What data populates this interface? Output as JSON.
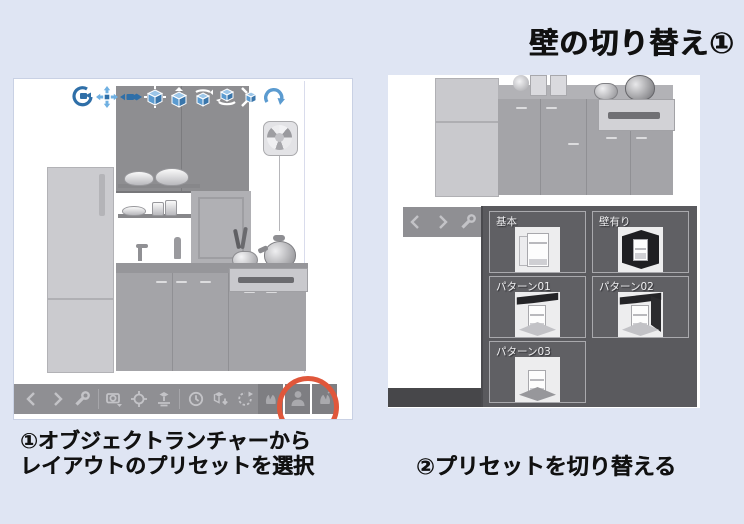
{
  "title": "壁の切り替え①",
  "colors": {
    "background": "#dfe5f3",
    "panel": "#ffffff",
    "toolbar_gray": "#8f8f93",
    "toolbar_icon": "#c3c3c7",
    "popup_gray": "#5a5a5e",
    "highlight_circle": "#e0573b",
    "tool_icon_blue": "#4e96cf"
  },
  "left_panel": {
    "top_toolbar": {
      "icons": [
        "camera-orbit",
        "camera-pan",
        "camera-zoom",
        "object-move",
        "object-lift",
        "object-rotate-y",
        "object-rotate-plane",
        "object-rotate-3d",
        "reset-view"
      ]
    },
    "bottom_toolbar": {
      "icons": [
        "prev",
        "next",
        "settings",
        "camera-angle",
        "focus-object",
        "object-ground",
        "pose-timer",
        "import-model",
        "rotate-reset",
        "hand-pose-left",
        "body-layout-preset",
        "hand-pose-right"
      ],
      "highlighted_icon": "body-layout-preset"
    },
    "caption": {
      "line1": "①オブジェクトランチャーから",
      "line2": "レイアウトのプリセットを選択"
    }
  },
  "right_panel": {
    "toolbar": {
      "icons": [
        "prev",
        "next",
        "settings"
      ]
    },
    "preset_panel": {
      "items": [
        {
          "label": "基本"
        },
        {
          "label": "壁有り"
        },
        {
          "label": "パターン01"
        },
        {
          "label": "パターン02"
        },
        {
          "label": "パターン03"
        }
      ]
    },
    "caption": "②プリセットを切り替える"
  }
}
